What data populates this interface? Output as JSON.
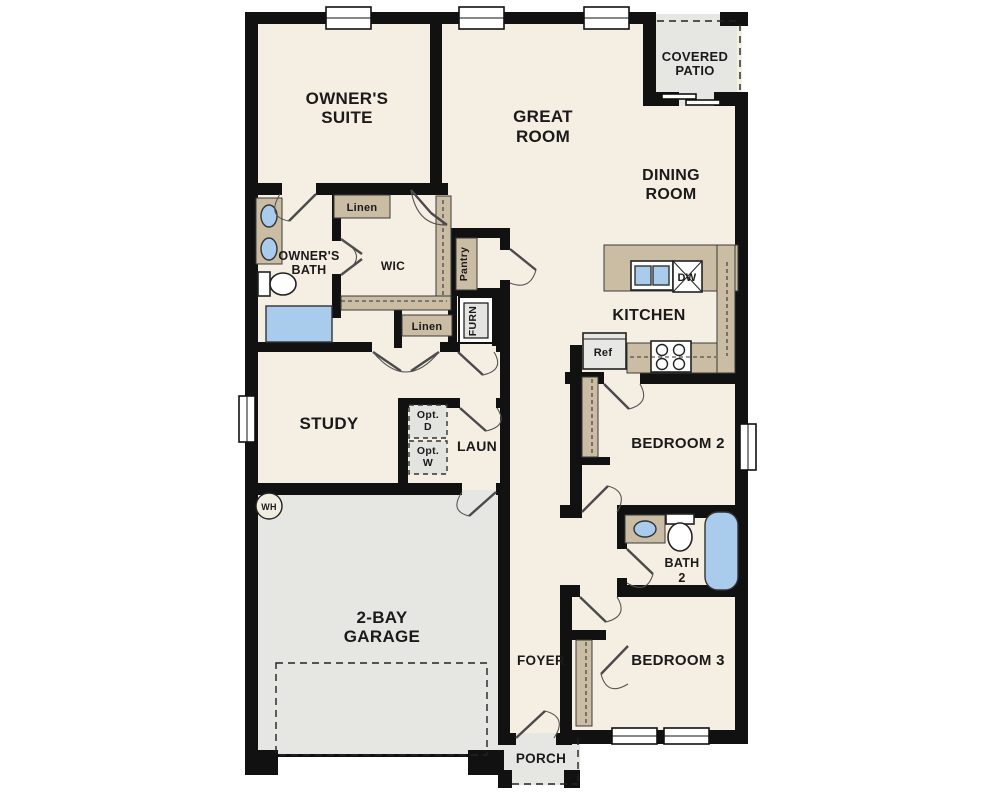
{
  "floorplan": {
    "rooms": {
      "owners_suite": {
        "line1": "OWNER'S",
        "line2": "SUITE"
      },
      "great_room": {
        "line1": "GREAT",
        "line2": "ROOM"
      },
      "covered_patio": {
        "line1": "COVERED",
        "line2": "PATIO"
      },
      "dining_room": {
        "line1": "DINING",
        "line2": "ROOM"
      },
      "kitchen": {
        "label": "KITCHEN"
      },
      "owners_bath": {
        "line1": "OWNER'S",
        "line2": "BATH"
      },
      "wic": {
        "label": "WIC"
      },
      "study": {
        "label": "STUDY"
      },
      "laundry": {
        "label": "LAUN"
      },
      "bedroom2": {
        "label": "BEDROOM 2"
      },
      "bath2": {
        "line1": "BATH",
        "line2": "2"
      },
      "bedroom3": {
        "label": "BEDROOM 3"
      },
      "garage": {
        "line1": "2-BAY",
        "line2": "GARAGE"
      },
      "foyer": {
        "label": "FOYER"
      },
      "porch": {
        "label": "PORCH"
      }
    },
    "closets": {
      "linen_upper": "Linen",
      "linen_lower": "Linen",
      "pantry": "Pantry",
      "furnace": "FURN"
    },
    "appliances": {
      "dishwasher": "DW",
      "refrigerator": "Ref",
      "water_heater": "WH",
      "optional_dryer": {
        "line1": "Opt.",
        "line2": "D"
      },
      "optional_washer": {
        "line1": "Opt.",
        "line2": "W"
      }
    },
    "colors": {
      "floor": "#f5eee2",
      "wall": "#111111",
      "casework": "#cbbda4",
      "concrete": "#e6e6e3",
      "fixture_blue": "#a9cbec",
      "option_fill": "#e3e3e0"
    }
  }
}
